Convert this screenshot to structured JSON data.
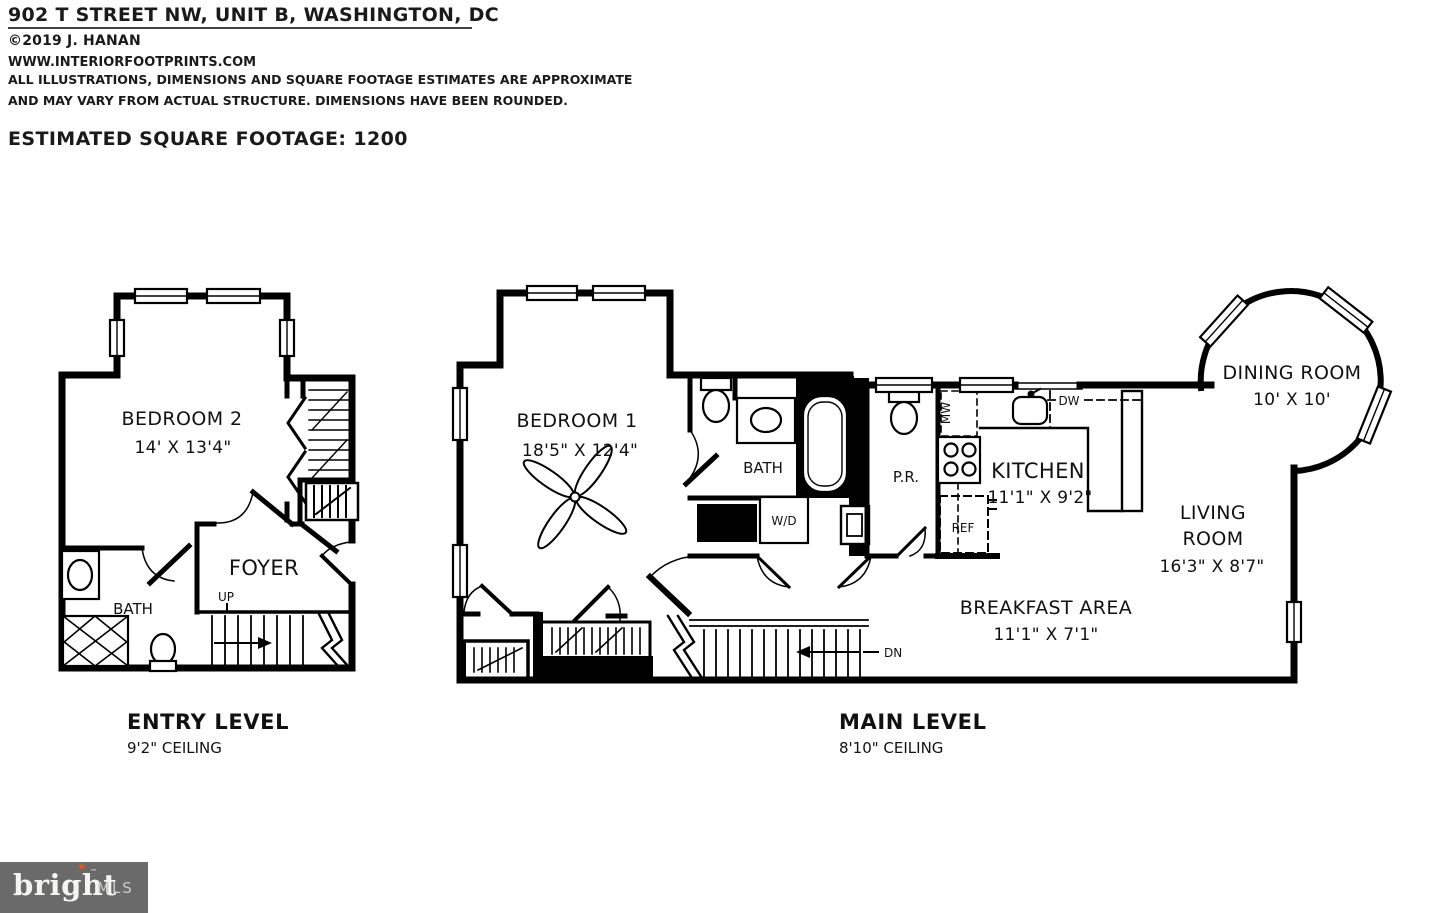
{
  "header": {
    "title": "902 T STREET NW, UNIT B, WASHINGTON, DC",
    "copyright": "©2019 J. HANAN",
    "website": "WWW.INTERIORFOOTPRINTS.COM",
    "disclaimer_line1": "ALL ILLUSTRATIONS, DIMENSIONS AND SQUARE FOOTAGE ESTIMATES ARE APPROXIMATE",
    "disclaimer_line2": "AND MAY VARY FROM ACTUAL STRUCTURE. DIMENSIONS HAVE BEEN ROUNDED.",
    "square_footage": "ESTIMATED SQUARE FOOTAGE: 1200"
  },
  "entry_level": {
    "title": "ENTRY LEVEL",
    "ceiling": "9'2\" CEILING",
    "bedroom2_label": "BEDROOM 2",
    "bedroom2_dims": "14' X 13'4\"",
    "foyer_label": "FOYER",
    "bath_label": "BATH",
    "stairs_label": "UP"
  },
  "main_level": {
    "title": "MAIN LEVEL",
    "ceiling": "8'10\" CEILING",
    "bedroom1_label": "BEDROOM 1",
    "bedroom1_dims": "18'5\" X 12'4\"",
    "bath_label": "BATH",
    "powder_room_label": "P.R.",
    "kitchen_label": "KITCHEN",
    "kitchen_dims": "11'1\" X 9'2\"",
    "dining_label": "DINING ROOM",
    "dining_dims": "10' X 10'",
    "living_label_1": "LIVING",
    "living_label_2": "ROOM",
    "living_dims": "16'3\" X 8'7\"",
    "breakfast_label": "BREAKFAST AREA",
    "breakfast_dims": "11'1\" X 7'1\"",
    "washer_dryer": "W/D",
    "microwave": "MW",
    "dishwasher": "DW",
    "refrigerator": "REF",
    "stairs_label": "DN"
  },
  "logo": {
    "brand": "bright",
    "suffix": "MLS",
    "trademark": "™",
    "star": "✦",
    "bg_color": "#6a6a6a",
    "star_color": "#e8541d",
    "wall_color": "#000000"
  }
}
